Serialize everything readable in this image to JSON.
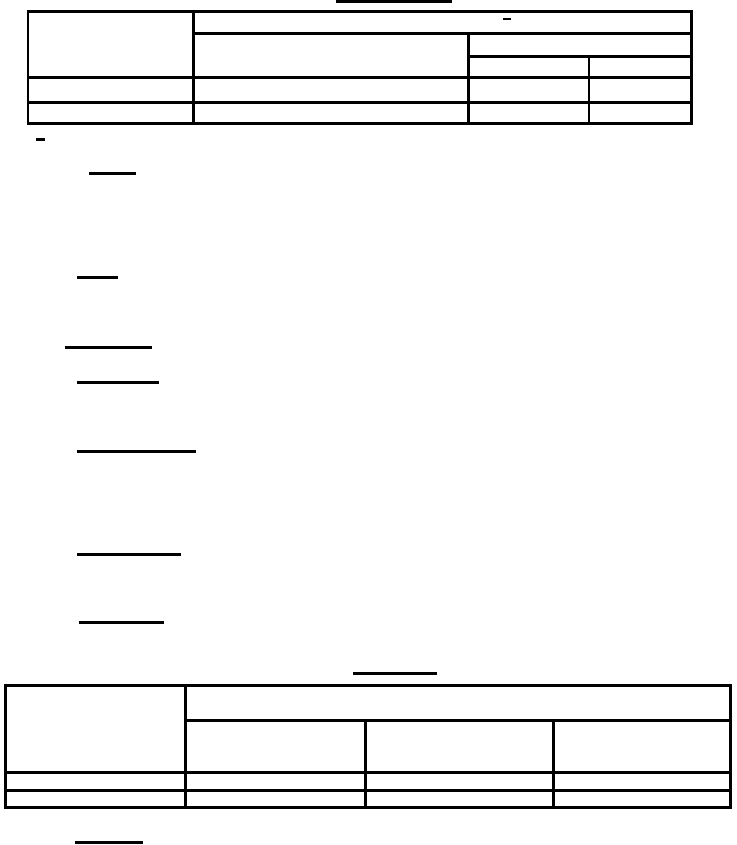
{
  "canvas": {
    "width_px": 737,
    "height_px": 845,
    "background_color": "#ffffff",
    "ink_color": "#000000",
    "visible_text": "none (document text layer not rendered; only rules, underlines and two dash glyphs are visible)"
  },
  "glyphs": [
    {
      "name": "table1-header-dash-glyph",
      "char": "-",
      "x": 503,
      "y": 18,
      "w": 8,
      "h": 2
    },
    {
      "name": "section-dash-glyph",
      "char": "-",
      "x": 36,
      "y": 138,
      "w": 9,
      "h": 3
    }
  ],
  "underlines": [
    {
      "name": "page-title-underline",
      "x": 336,
      "y": 0,
      "w": 116,
      "h": 3
    },
    {
      "name": "heading-underline-1",
      "x": 89,
      "y": 172,
      "w": 47,
      "h": 3
    },
    {
      "name": "heading-underline-2",
      "x": 77,
      "y": 276,
      "w": 41,
      "h": 3
    },
    {
      "name": "heading-underline-3",
      "x": 65,
      "y": 346,
      "w": 87,
      "h": 3
    },
    {
      "name": "heading-underline-4",
      "x": 77,
      "y": 381,
      "w": 82,
      "h": 3
    },
    {
      "name": "heading-underline-5",
      "x": 77,
      "y": 450,
      "w": 119,
      "h": 3
    },
    {
      "name": "heading-underline-6",
      "x": 77,
      "y": 553,
      "w": 104,
      "h": 3
    },
    {
      "name": "heading-underline-7",
      "x": 79,
      "y": 621,
      "w": 85,
      "h": 3
    },
    {
      "name": "table2-title-underline",
      "x": 353,
      "y": 672,
      "w": 84,
      "h": 3
    },
    {
      "name": "footer-heading-underline",
      "x": 75,
      "y": 841,
      "w": 68,
      "h": 3
    }
  ],
  "table1": {
    "lines": [
      {
        "name": "table1-border-top",
        "x": 27,
        "y": 10,
        "w": 666,
        "h": 3
      },
      {
        "name": "table1-headerrow1-bottom-rule",
        "x": 192,
        "y": 32,
        "w": 501,
        "h": 3
      },
      {
        "name": "table1-right-header-split-rule",
        "x": 467,
        "y": 55,
        "w": 226,
        "h": 3
      },
      {
        "name": "table1-header-bottom-rule",
        "x": 27,
        "y": 76,
        "w": 666,
        "h": 3
      },
      {
        "name": "table1-bodyrow-divider-rule",
        "x": 27,
        "y": 101,
        "w": 666,
        "h": 3
      },
      {
        "name": "table1-border-bottom",
        "x": 27,
        "y": 122,
        "w": 666,
        "h": 3
      },
      {
        "name": "table1-border-left",
        "x": 27,
        "y": 10,
        "w": 2,
        "h": 115
      },
      {
        "name": "table1-col1-divider",
        "x": 192,
        "y": 10,
        "w": 3,
        "h": 115
      },
      {
        "name": "table1-col2-divider",
        "x": 467,
        "y": 32,
        "w": 3,
        "h": 93
      },
      {
        "name": "table1-col3-divider",
        "x": 588,
        "y": 55,
        "w": 2,
        "h": 70
      },
      {
        "name": "table1-border-right",
        "x": 690,
        "y": 10,
        "w": 3,
        "h": 115
      }
    ],
    "cells": [
      {
        "name": "table1-cell-header-col1-merged",
        "x": 29,
        "y": 13,
        "w": 163,
        "h": 63
      },
      {
        "name": "table1-cell-header-span-row",
        "x": 195,
        "y": 13,
        "w": 495,
        "h": 19
      },
      {
        "name": "table1-cell-header-col2-merged",
        "x": 195,
        "y": 35,
        "w": 272,
        "h": 41
      },
      {
        "name": "table1-cell-header-right-span",
        "x": 470,
        "y": 35,
        "w": 220,
        "h": 20
      },
      {
        "name": "table1-cell-header-col3",
        "x": 470,
        "y": 58,
        "w": 118,
        "h": 18
      },
      {
        "name": "table1-cell-header-col4",
        "x": 590,
        "y": 58,
        "w": 100,
        "h": 18
      },
      {
        "name": "table1-cell-row1-col1",
        "x": 29,
        "y": 79,
        "w": 163,
        "h": 22
      },
      {
        "name": "table1-cell-row1-col2",
        "x": 195,
        "y": 79,
        "w": 272,
        "h": 22
      },
      {
        "name": "table1-cell-row1-col3",
        "x": 470,
        "y": 79,
        "w": 118,
        "h": 22
      },
      {
        "name": "table1-cell-row1-col4",
        "x": 590,
        "y": 79,
        "w": 100,
        "h": 22
      },
      {
        "name": "table1-cell-row2-col1",
        "x": 29,
        "y": 104,
        "w": 163,
        "h": 18
      },
      {
        "name": "table1-cell-row2-col2",
        "x": 195,
        "y": 104,
        "w": 272,
        "h": 18
      },
      {
        "name": "table1-cell-row2-col3",
        "x": 470,
        "y": 104,
        "w": 118,
        "h": 18
      },
      {
        "name": "table1-cell-row2-col4",
        "x": 590,
        "y": 104,
        "w": 100,
        "h": 18
      }
    ]
  },
  "table2": {
    "lines": [
      {
        "name": "table2-border-top",
        "x": 4,
        "y": 684,
        "w": 728,
        "h": 3
      },
      {
        "name": "table2-headerrow1-bottom-rule",
        "x": 184,
        "y": 719,
        "w": 548,
        "h": 3
      },
      {
        "name": "table2-header-bottom-rule",
        "x": 4,
        "y": 771,
        "w": 728,
        "h": 3
      },
      {
        "name": "table2-bodyrow-divider-rule",
        "x": 4,
        "y": 789,
        "w": 728,
        "h": 3
      },
      {
        "name": "table2-border-bottom",
        "x": 4,
        "y": 806,
        "w": 728,
        "h": 3
      },
      {
        "name": "table2-border-left",
        "x": 4,
        "y": 684,
        "w": 3,
        "h": 125
      },
      {
        "name": "table2-col1-divider",
        "x": 184,
        "y": 684,
        "w": 3,
        "h": 125
      },
      {
        "name": "table2-col2-divider",
        "x": 364,
        "y": 719,
        "w": 3,
        "h": 90
      },
      {
        "name": "table2-col3-divider",
        "x": 552,
        "y": 719,
        "w": 3,
        "h": 90
      },
      {
        "name": "table2-border-right",
        "x": 729,
        "y": 684,
        "w": 3,
        "h": 125
      }
    ],
    "cells": [
      {
        "name": "table2-cell-header-col1-merged",
        "x": 7,
        "y": 687,
        "w": 177,
        "h": 84
      },
      {
        "name": "table2-cell-header-span-row",
        "x": 187,
        "y": 687,
        "w": 542,
        "h": 32
      },
      {
        "name": "table2-cell-header-col2",
        "x": 187,
        "y": 722,
        "w": 177,
        "h": 49
      },
      {
        "name": "table2-cell-header-col3",
        "x": 367,
        "y": 722,
        "w": 185,
        "h": 49
      },
      {
        "name": "table2-cell-header-col4",
        "x": 555,
        "y": 722,
        "w": 174,
        "h": 49
      },
      {
        "name": "table2-cell-row1-col1",
        "x": 7,
        "y": 774,
        "w": 177,
        "h": 15
      },
      {
        "name": "table2-cell-row1-col2",
        "x": 187,
        "y": 774,
        "w": 177,
        "h": 15
      },
      {
        "name": "table2-cell-row1-col3",
        "x": 367,
        "y": 774,
        "w": 185,
        "h": 15
      },
      {
        "name": "table2-cell-row1-col4",
        "x": 555,
        "y": 774,
        "w": 174,
        "h": 15
      },
      {
        "name": "table2-cell-row2-col1",
        "x": 7,
        "y": 792,
        "w": 177,
        "h": 14
      },
      {
        "name": "table2-cell-row2-col2",
        "x": 187,
        "y": 792,
        "w": 177,
        "h": 14
      },
      {
        "name": "table2-cell-row2-col3",
        "x": 367,
        "y": 792,
        "w": 185,
        "h": 14
      },
      {
        "name": "table2-cell-row2-col4",
        "x": 555,
        "y": 792,
        "w": 174,
        "h": 14
      }
    ]
  }
}
